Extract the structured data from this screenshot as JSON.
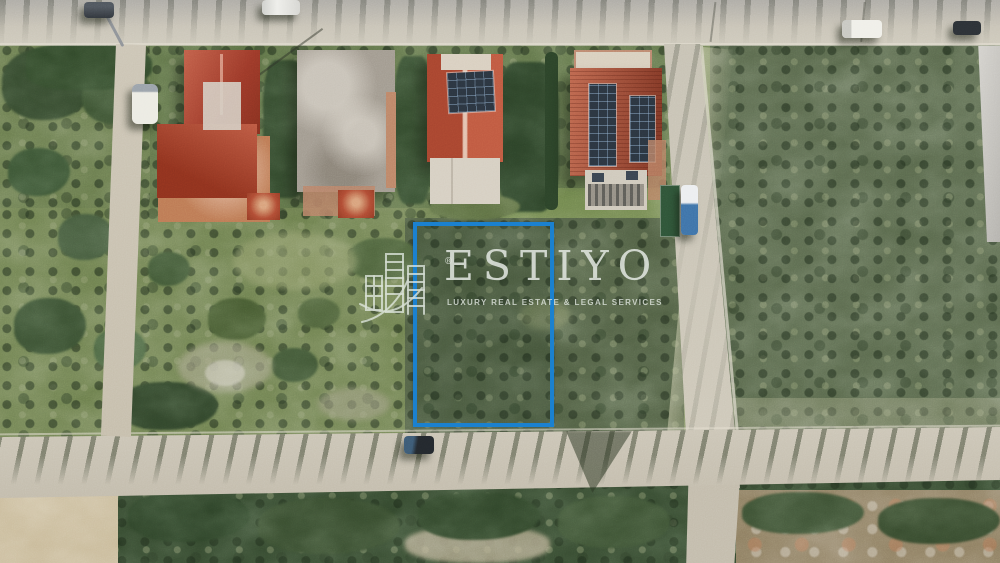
{
  "watermark": {
    "brand": "ESTIYO",
    "registered": "®",
    "tagline": "LUXURY REAL ESTATE & LEGAL SERVICES",
    "icon": "buildings-logo-icon"
  },
  "property": {
    "boundary_shape": "rectangle",
    "boundary_outline_color": "#1b81cf"
  },
  "colors": {
    "plot_outline": "#1b81cf",
    "watermark_text": "#e4e9e3",
    "road_surface": "#c6bfb0",
    "field_green": "#6d8050",
    "scrub_green": "#55644a",
    "roof_red": "#a84a34",
    "solar_panel": "#2b3540",
    "dirt_tan": "#8d7d60"
  }
}
